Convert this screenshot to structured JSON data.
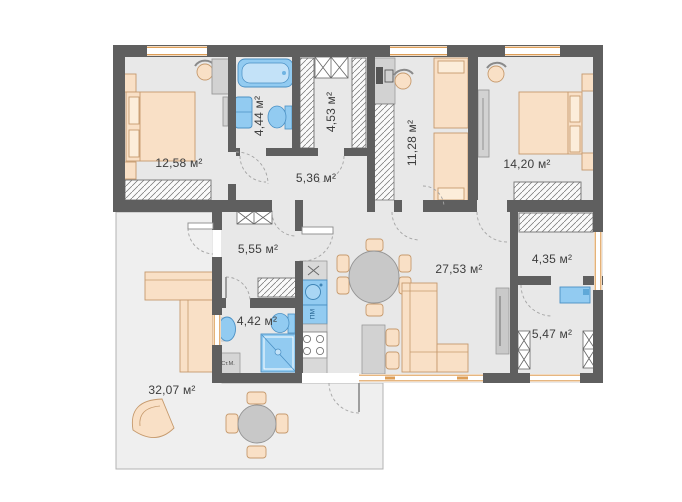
{
  "plan": {
    "rooms": [
      {
        "id": "bedroom-1",
        "area_label": "12,58 м²"
      },
      {
        "id": "bathroom-1",
        "area_label": "4,44 м²"
      },
      {
        "id": "wardrobe-room",
        "area_label": "4,53 м²"
      },
      {
        "id": "hallway",
        "area_label": "5,36 м²"
      },
      {
        "id": "kids-room",
        "area_label": "11,28 м²"
      },
      {
        "id": "bedroom-2",
        "area_label": "14,20 м²"
      },
      {
        "id": "entry-hall",
        "area_label": "5,55 м²"
      },
      {
        "id": "living-kitchen",
        "area_label": "27,53 м²"
      },
      {
        "id": "dressing-room",
        "area_label": "4,35 м²"
      },
      {
        "id": "bathroom-2",
        "area_label": "4,42 м²"
      },
      {
        "id": "utility-room",
        "area_label": "5,47 м²"
      },
      {
        "id": "terrace",
        "area_label": "32,07 м²"
      }
    ],
    "appliance_labels": {
      "washing_machine": "Ст.М.",
      "dishwasher": "ПМ"
    },
    "colors": {
      "wall": "#5f5f5f",
      "floor": "#e8e8e8",
      "terrace_floor": "#efefef",
      "furniture_fill": "#f9e0c6",
      "furniture_stroke": "#c69a6d",
      "fixture_blue": "#92cbf1",
      "fixture_blue_light": "#c3e2f8",
      "fixture_blue_stroke": "#4a90c4",
      "window_accent": "#dd9e57",
      "gray_furniture": "#d2d2d2",
      "label_text": "#3d3d3d"
    }
  }
}
